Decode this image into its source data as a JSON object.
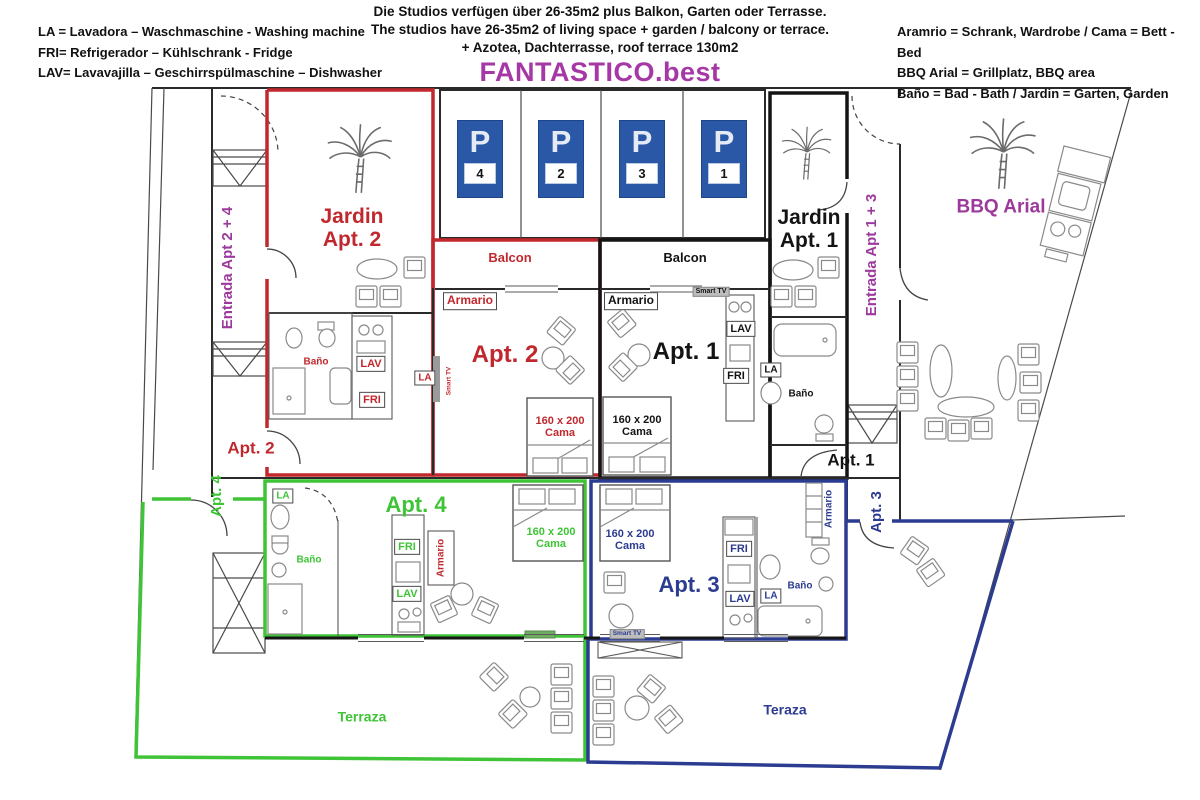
{
  "header": {
    "legend_left": [
      "LA = Lavadora – Waschmaschine - Washing machine",
      "FRI= Refrigerador – Kühlschrank - Fridge",
      "LAV= Lavavajilla – Geschirrspülmaschine – Dishwasher"
    ],
    "center_lines": [
      "Die Studios verfügen über 26-35m2 plus Balkon, Garten oder Terrasse.",
      "The studios have 26-35m2 of living space + garden / balcony or terrace.",
      "+ Azotea, Dachterrasse, roof terrace 130m2"
    ],
    "brand": "FANTASTICO.best",
    "legend_right": [
      "Aramrio = Schrank, Wardrobe / Cama = Bett - Bed",
      "BBQ Arial = Grillplatz, BBQ area",
      "Baño = Bad -  Bath / Jardin = Garten, Garden"
    ]
  },
  "parking": {
    "p": "P",
    "spaces": [
      "4",
      "2",
      "3",
      "1"
    ]
  },
  "labels": {
    "entrada_24": "Entrada Apt 2 + 4",
    "entrada_13": "Entrada Apt 1 + 3",
    "jardin_apt2": "Jardin\nApt. 2",
    "jardin_apt1": "Jardin\nApt. 1",
    "bbq": "BBQ Arial",
    "apt1": "Apt. 1",
    "apt2": "Apt. 2",
    "apt3": "Apt. 3",
    "apt4": "Apt. 4",
    "balcon": "Balcon",
    "armario": "Armario",
    "banio": "Baño",
    "lav": "LAV",
    "fri": "FRI",
    "la": "LA",
    "cama": "160 x 200\nCama",
    "smart_tv": "Smart TV",
    "terraza": "Terraza",
    "teraza": "Teraza"
  },
  "colors": {
    "red": "#c1282d",
    "green": "#3fc437",
    "blue": "#2c3c90",
    "purple": "#9c3a9c",
    "parking_blue": "#2a58a6",
    "brand_purple": "#a538a5",
    "wall": "#2a2a2a"
  }
}
